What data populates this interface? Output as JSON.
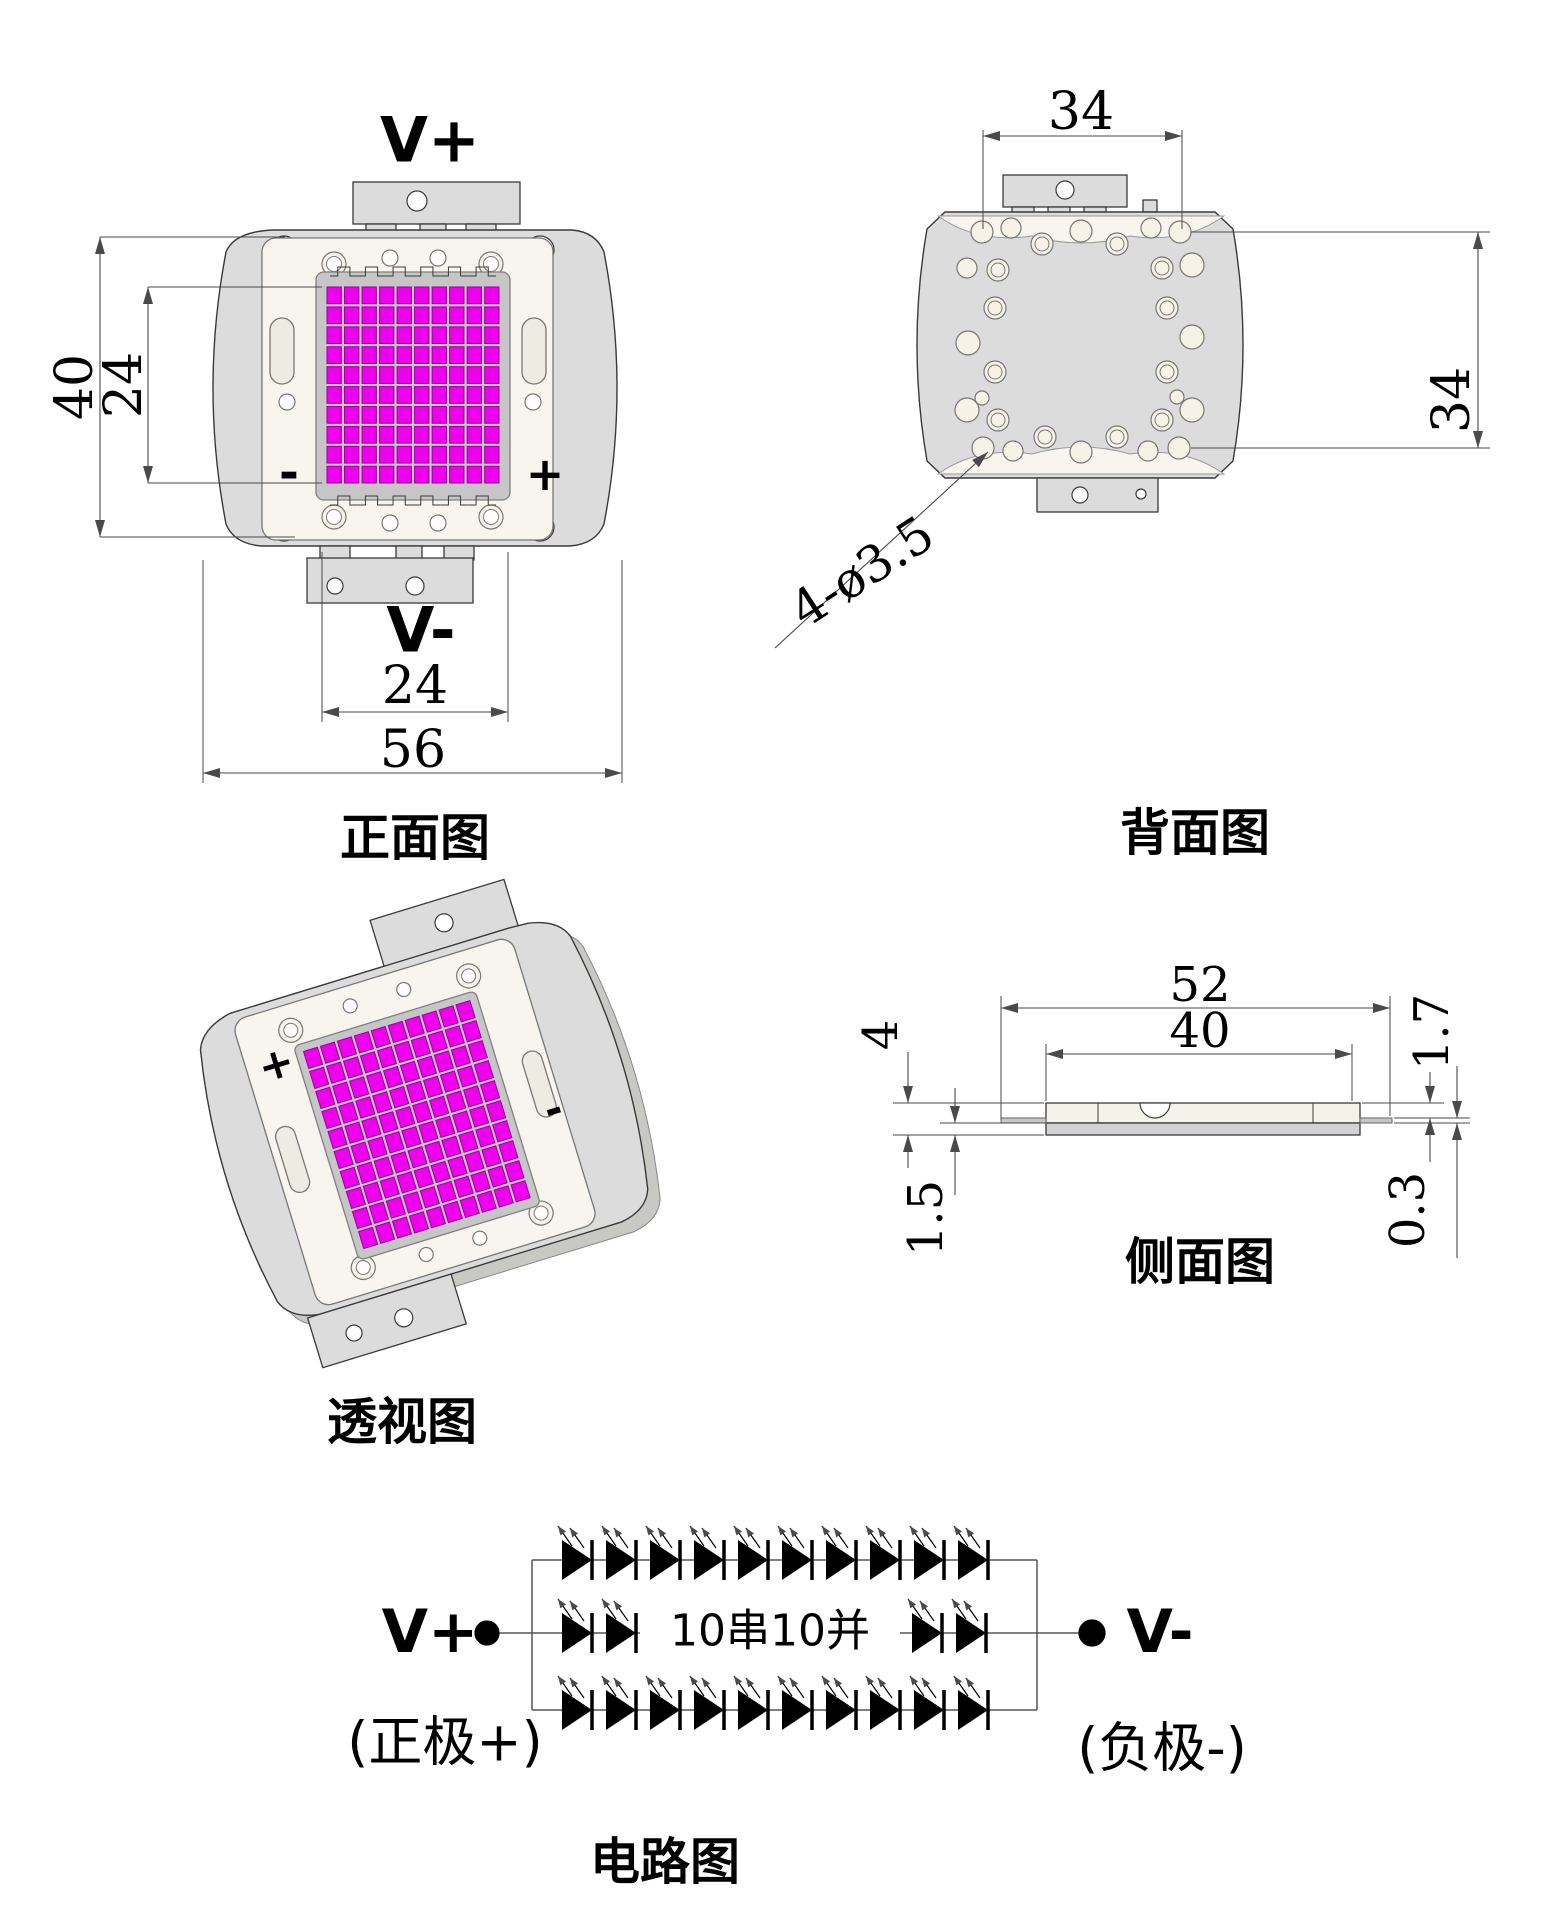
{
  "colors": {
    "line": "#3a3a3a",
    "dim_line": "#4a4a4a",
    "body_fill": "#dcdcdc",
    "body_back_fill": "#ececea",
    "body_shadow": "#c9c9c4",
    "plate_fill": "#f7f5ee",
    "slot_fill": "#edebe2",
    "ring_fill": "#f6f2e6",
    "hole_fill": "#ffffff",
    "substrate_fill": "#c6c6c6",
    "led": "#ee00ee",
    "led_border": "#9b009b",
    "pad_fill": "#dcdcdc",
    "side_top_fill": "#f4f3e9",
    "side_bottom_fill": "#d2d2d2",
    "tab_fill": "#c6c6c6",
    "text": "#000000"
  },
  "led_grid": {
    "rows": 10,
    "cols": 10
  },
  "views": {
    "front": {
      "label": "正面图",
      "terminal_top": "V+",
      "terminal_bottom": "V-",
      "polarity_left": "-",
      "polarity_right": "+",
      "dim_total_height": "40",
      "dim_emitting_height": "24",
      "dim_emitting_width": "24",
      "dim_total_width": "56"
    },
    "back": {
      "label": "背面图",
      "dim_width": "34",
      "dim_height": "34",
      "dim_mounting_holes": "4-ø3.5"
    },
    "perspective": {
      "label": "透视图",
      "polarity_plus": "+",
      "polarity_minus": "-"
    },
    "side": {
      "label": "侧面图",
      "dim_outer_width": "52",
      "dim_inner_width": "40",
      "dim_total_thickness": "4",
      "dim_base_thickness": "1.5",
      "dim_top_thickness": "1.7",
      "dim_lead_thickness": "0.3"
    },
    "circuit": {
      "label": "电路图",
      "terminal_positive": "V+",
      "terminal_negative": "V-",
      "note_positive": "(正极+)",
      "note_negative": "(负极-)",
      "configuration": "10串10并",
      "diodes_top_row": 10,
      "diodes_middle_left": 2,
      "diodes_middle_right": 2,
      "diodes_bottom_row": 10
    }
  }
}
